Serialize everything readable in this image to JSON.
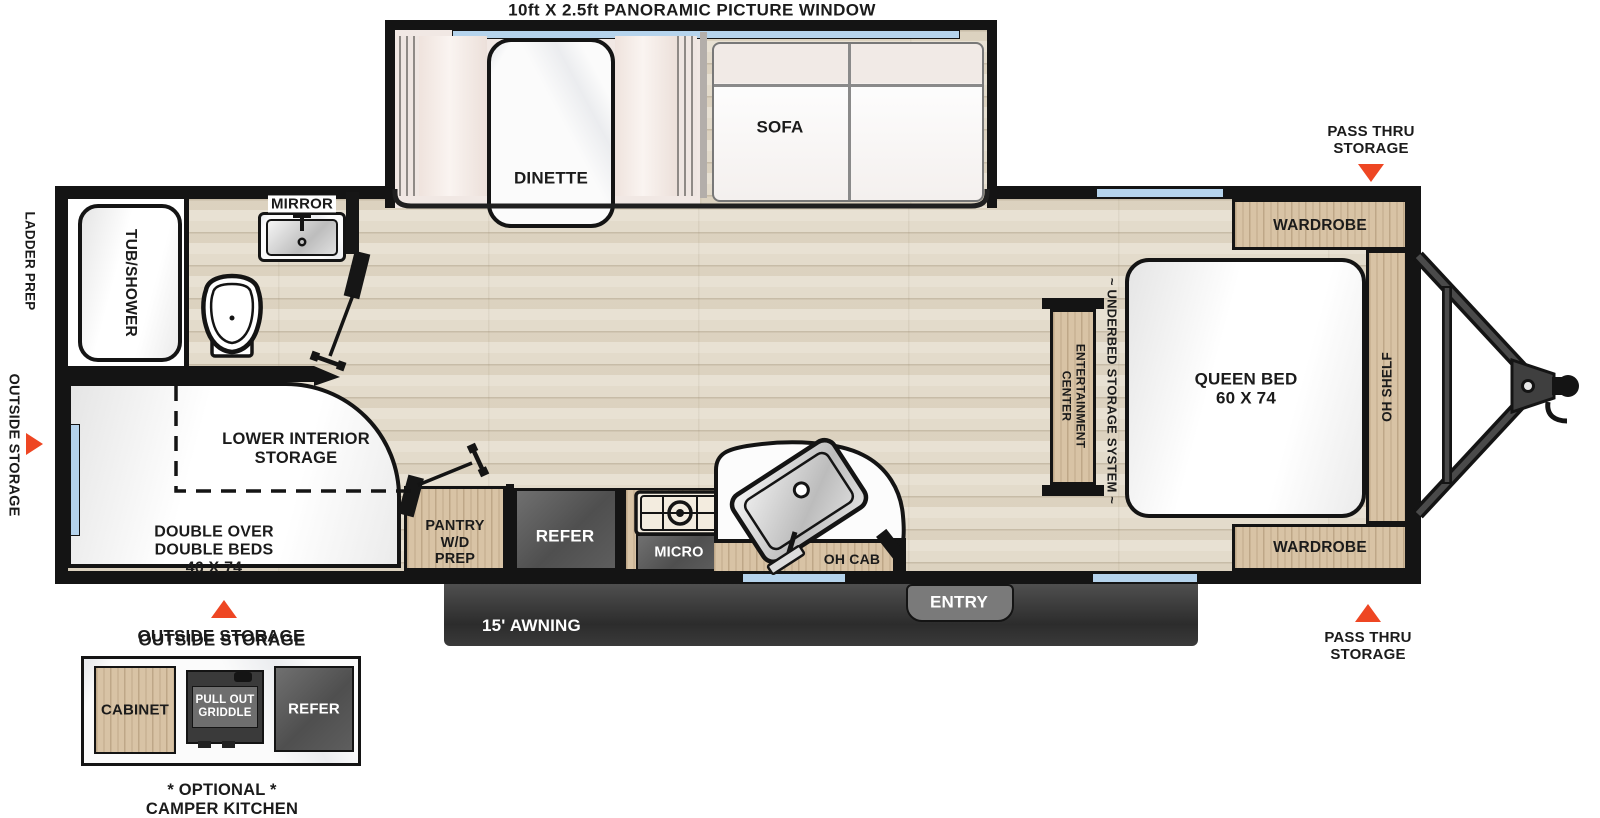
{
  "title": "10ft X 2.5ft PANORAMIC PICTURE WINDOW",
  "slideout": {
    "dinette": "DINETTE",
    "sofa": "SOFA"
  },
  "bathroom": {
    "mirror": "MIRROR",
    "tub_shower": "TUB/SHOWER"
  },
  "rear": {
    "ladder_prep": "LADDER PREP",
    "outside_storage": "OUTSIDE STORAGE"
  },
  "bunk": {
    "storage1": "LOWER INTERIOR",
    "storage2": "STORAGE",
    "beds1": "DOUBLE OVER",
    "beds2": "DOUBLE BEDS",
    "beds3": "46 X 74"
  },
  "kitchen": {
    "pantry1": "PANTRY",
    "pantry2": "W/D",
    "pantry3": "PREP",
    "refer": "REFER",
    "micro": "MICRO",
    "oh_cab": "OH CAB"
  },
  "bottom": {
    "entry": "ENTRY",
    "awning": "15' AWNING",
    "outside_storage": "OUTSIDE STORAGE"
  },
  "bedroom": {
    "wardrobe_top": "WARDROBE",
    "wardrobe_bottom": "WARDROBE",
    "queen1": "QUEEN BED",
    "queen2": "60 X 74",
    "oh_shelf": "OH SHELF",
    "ent1": "ENTERTAINMENT",
    "ent2": "CENTER",
    "underbed": "~ UNDERBED STORAGE SYSTEM ~",
    "pass_top1": "PASS THRU",
    "pass_top2": "STORAGE",
    "pass_bottom1": "PASS THRU",
    "pass_bottom2": "STORAGE"
  },
  "camper": {
    "heading": "OUTSIDE STORAGE",
    "cabinet": "CABINET",
    "griddle1": "PULL OUT",
    "griddle2": "GRIDDLE",
    "refer": "REFER",
    "caption1": "* OPTIONAL *",
    "caption2": "CAMPER KITCHEN"
  },
  "colors": {
    "accent": "#ee4623",
    "window": "#b5d3ec",
    "wood": "#d8c3a5",
    "floor": "#e3dbcb",
    "appliance": "#4f4f4f",
    "awning": "#2c2c2c",
    "wall": "#141414"
  }
}
